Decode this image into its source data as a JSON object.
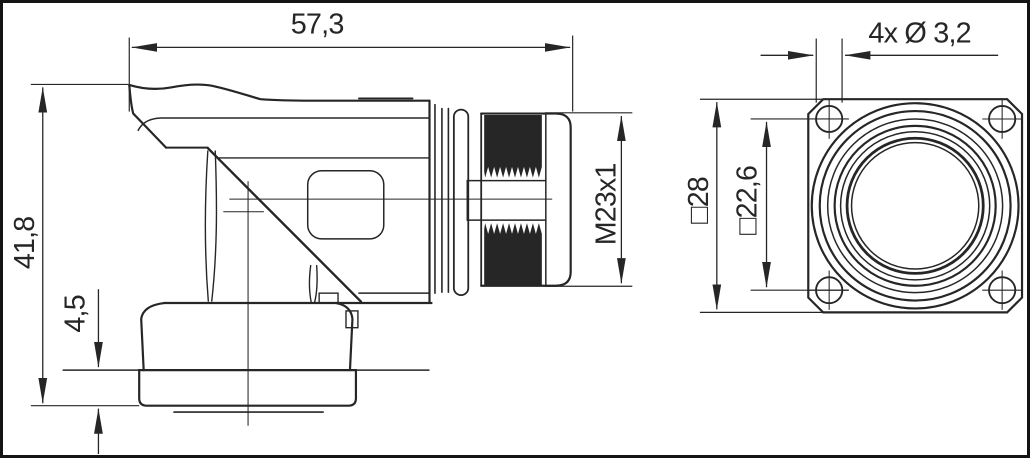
{
  "drawing": {
    "type": "technical-dimension-drawing",
    "background": "#ffffff",
    "ink_color": "#262626",
    "frame_color": "#141414",
    "dimensions": {
      "overall_length": "57,3",
      "overall_height": "41,8",
      "nut_height": "4,5",
      "thread": "M23x1",
      "mounting_holes": "4x Ø 3,2",
      "flange_square": "□28",
      "hole_pitch_square": "□22,6"
    }
  }
}
